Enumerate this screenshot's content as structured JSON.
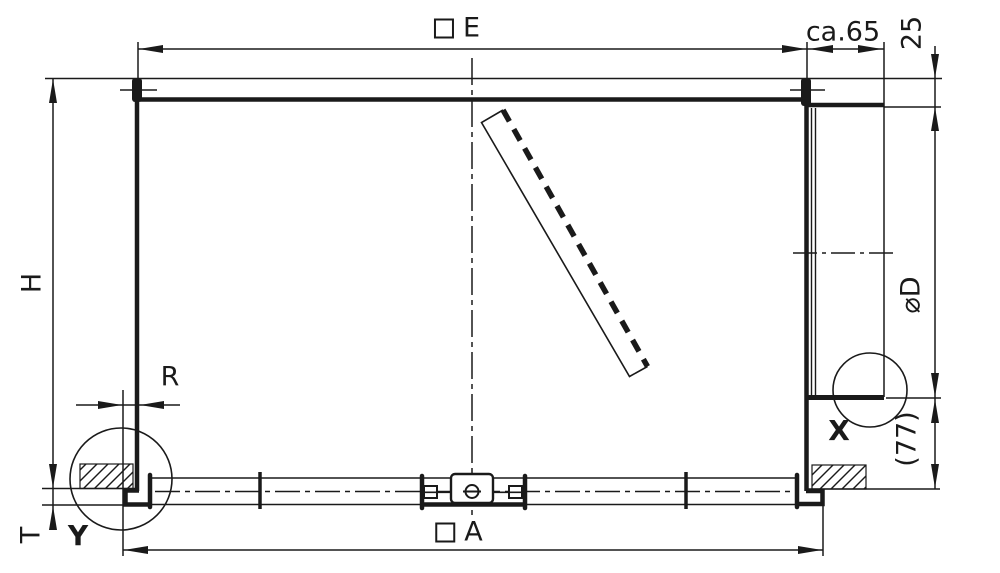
{
  "drawing": {
    "type": "technical-section-drawing",
    "labels": {
      "top_width": "E",
      "top_right_offset": "ca.65",
      "top_inset": "25",
      "height": "H",
      "tube_diameter": "⌀D",
      "ground_clearance": "(77)",
      "detail_x": "X",
      "detail_y": "Y",
      "rear_gap": "R",
      "base_width": "A",
      "base_thickness": "T"
    },
    "colors": {
      "line": "#1a1a1a",
      "background": "#ffffff"
    }
  }
}
